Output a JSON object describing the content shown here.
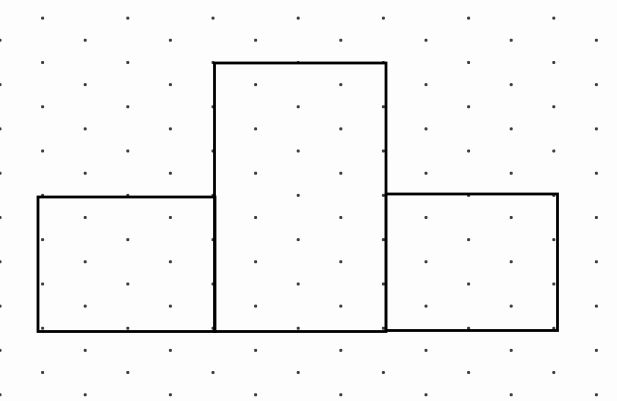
{
  "canvas": {
    "width": 617,
    "height": 401,
    "background": "#fdfdfd"
  },
  "grid": {
    "dot_color": "#222222",
    "dot_size": 3,
    "dot_opacity": 0.88,
    "first_row_y": -4,
    "row_spacing": 22.15,
    "col_spacing": 85.2,
    "odd_row_x_offset": 42.6,
    "row_count": 19
  },
  "figure": {
    "stroke_color": "#000000",
    "stroke_width": 2.8,
    "rectangles": [
      {
        "name": "left-rectangle",
        "x": 38,
        "y": 197,
        "width": 177,
        "height": 134.5
      },
      {
        "name": "middle-rectangle",
        "x": 214.5,
        "y": 63,
        "width": 171.5,
        "height": 268.5
      },
      {
        "name": "right-rectangle",
        "x": 386,
        "y": 194,
        "width": 171.5,
        "height": 136.5
      }
    ]
  }
}
